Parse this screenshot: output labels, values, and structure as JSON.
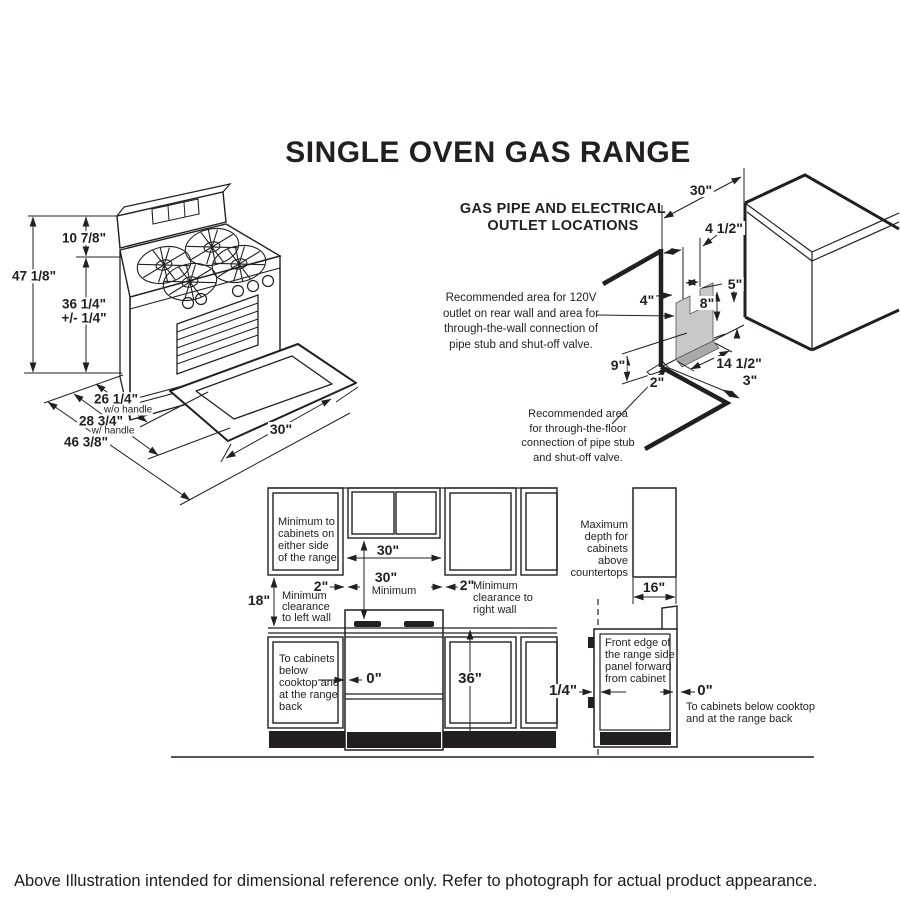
{
  "title": "SINGLE OVEN GAS RANGE",
  "caption": "Above Illustration intended for dimensional reference only. Refer to photograph for actual product appearance.",
  "range_view": {
    "dim_height_total": "47 1/8\"",
    "dim_height_backsplash": "10 7/8\"",
    "dim_height_cooktop": "36 1/4\"\n+/- 1/4\"",
    "dim_depth_wo_handle": "26 1/4\"",
    "note_wo_handle": "w/o handle",
    "dim_depth_w_handle": "28 3/4\"",
    "note_w_handle": "w/ handle",
    "dim_depth_total": "46 3/8\"",
    "dim_width": "30\""
  },
  "gas_diagram": {
    "title": "GAS PIPE AND ELECTRICAL\nOUTLET LOCATIONS",
    "note_wall": "Recommended area for 120V\noutlet on rear wall and area for\nthrough-the-wall connection of\npipe stub and shut-off valve.",
    "note_floor": "Recommended area\nfor through-the-floor\nconnection of pipe stub\nand shut-off valve.",
    "dim_wall_width": "30\"",
    "dim_notch_width": "4 1/2\"",
    "dim_gap_right": "5\"",
    "dim_notch_height": "8\"",
    "dim_offset_left": "4\"",
    "dim_area_height": "9\"",
    "dim_floor_offset": "2\"",
    "dim_area_width": "14 1/2\"",
    "dim_floor_depth": "3\""
  },
  "front_view": {
    "note_side_cabinets": "Minimum to\ncabinets on\neither side\nof the range.",
    "dim_opening": "30\"",
    "dim_min": "30\"",
    "label_minimum": "Minimum",
    "dim_left_gap": "2\"",
    "dim_right_gap": "2\"",
    "dim_counter_height": "18\"",
    "note_left_wall": "Minimum\nclearance\nto left wall",
    "note_right_wall": "Minimum\nclearance to\nright wall",
    "note_below_cabinets": "To cabinets\nbelow\ncooktop and\nat the range\nback",
    "dim_zero": "0\"",
    "dim_36": "36\""
  },
  "side_view": {
    "note_max_depth": "Maximum\ndepth for\ncabinets above\ncountertops",
    "dim_16": "16\"",
    "note_front_edge": "Front edge of\nthe range side\npanel forward\nfrom cabinet",
    "dim_quarter": "1/4\"",
    "dim_zero": "0\"",
    "note_below_cabinets": "To cabinets below cooktop\nand at the range back"
  }
}
